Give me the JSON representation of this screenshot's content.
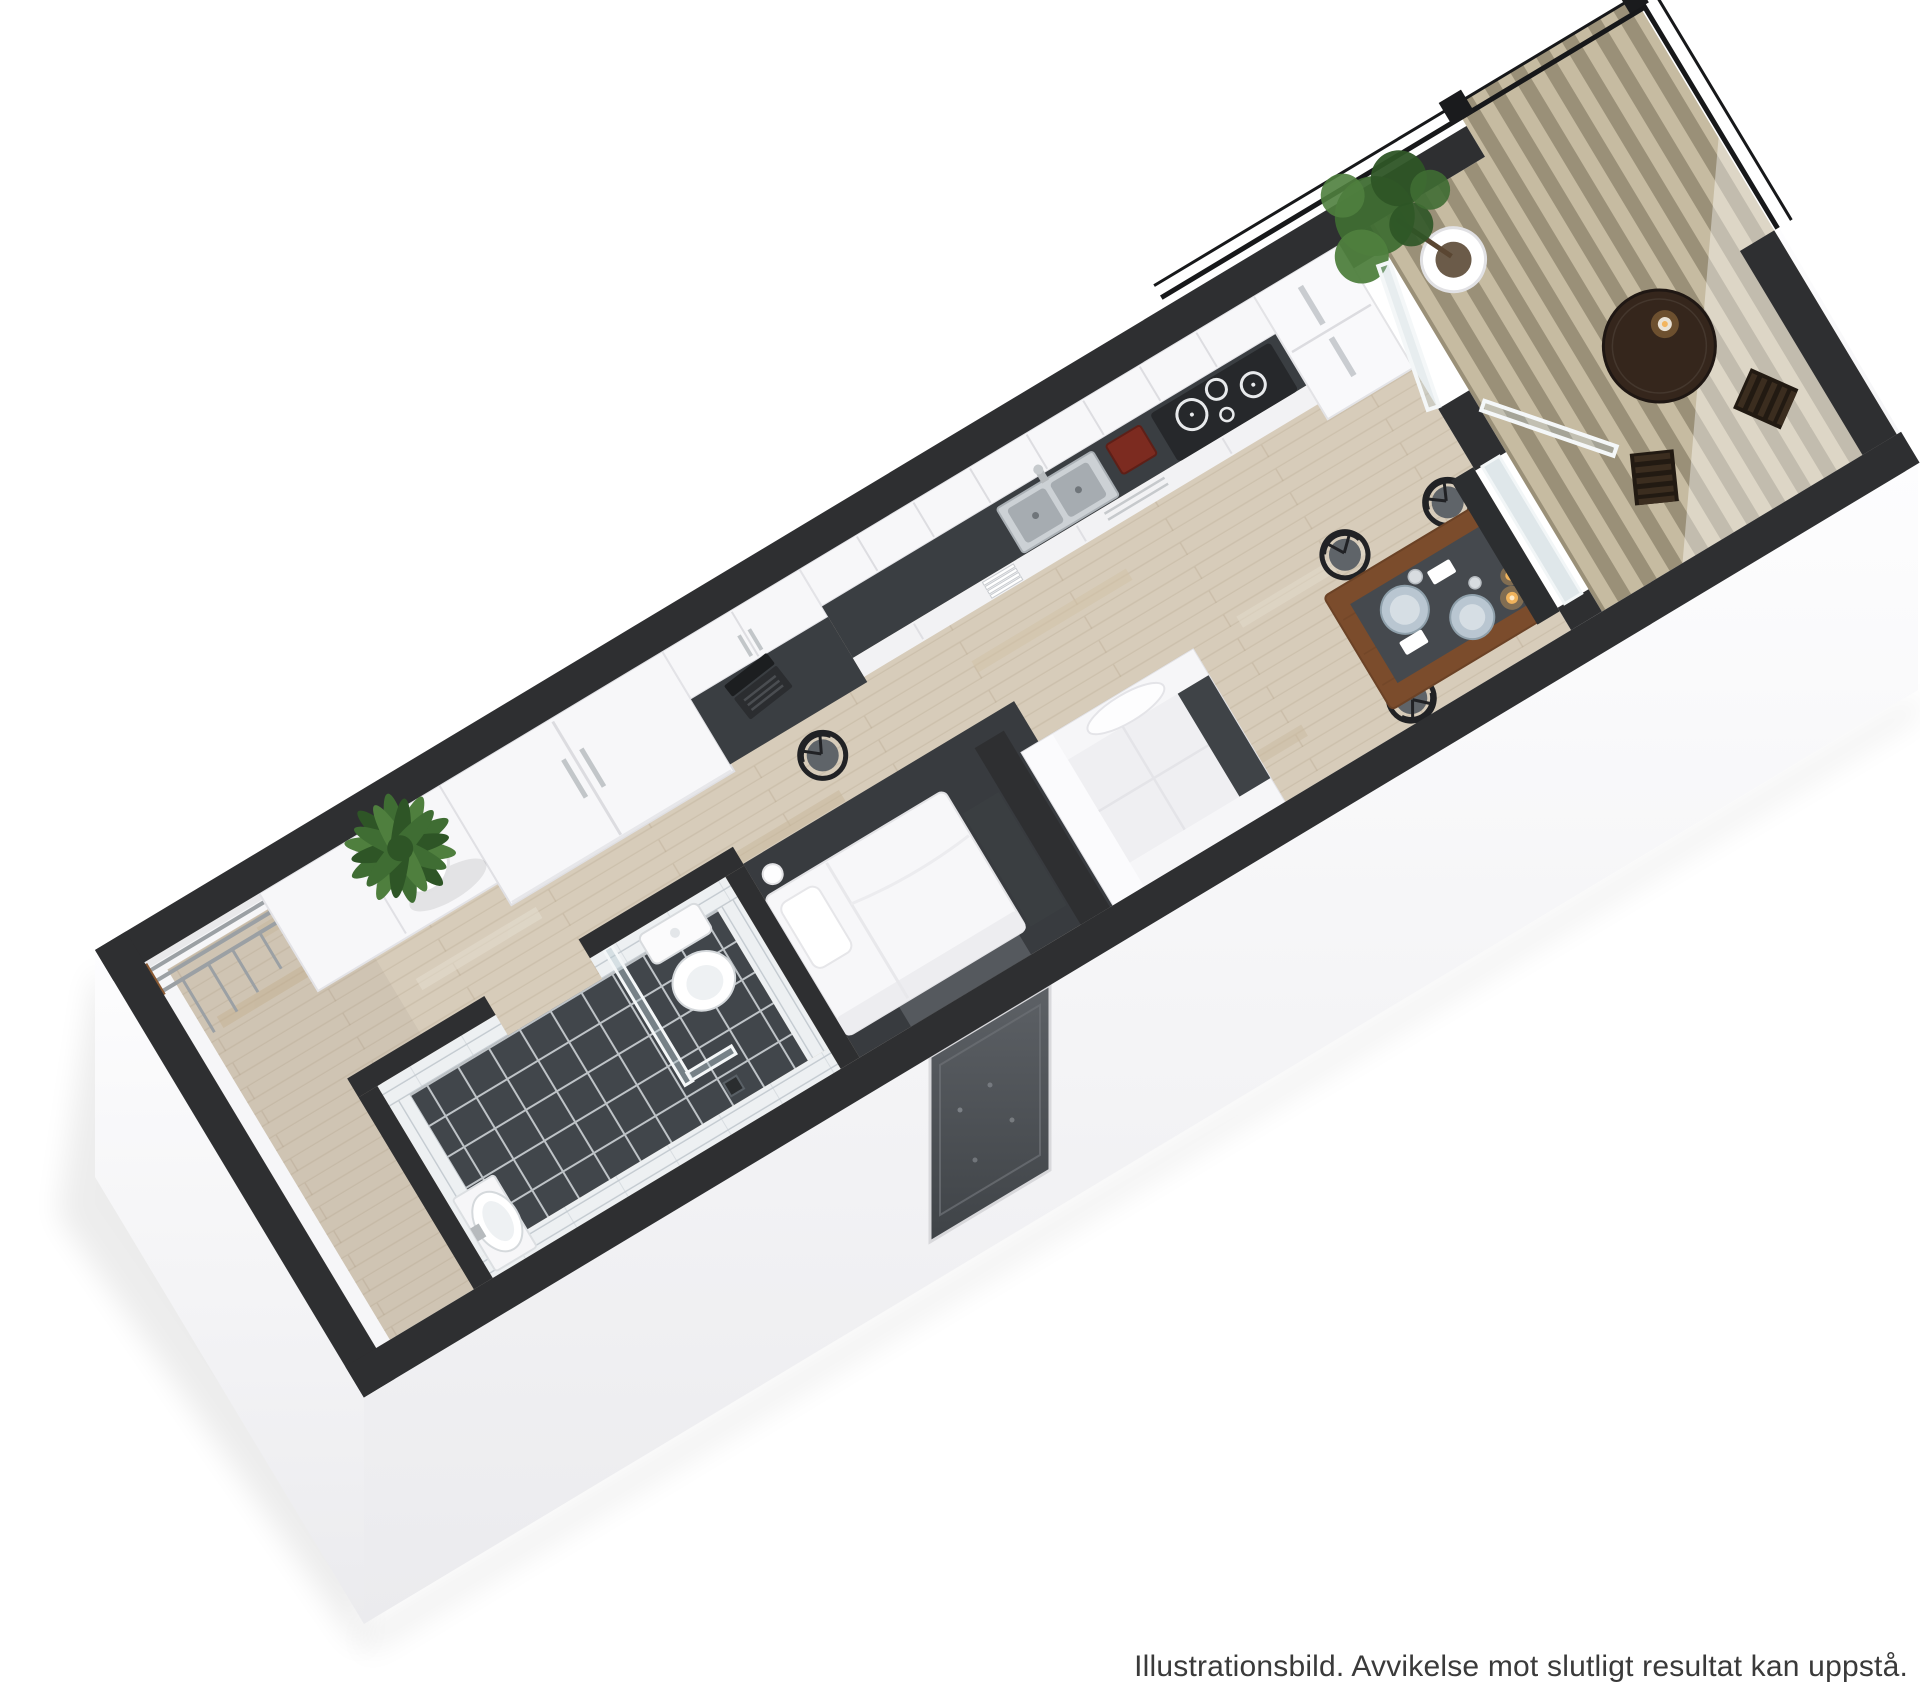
{
  "caption": {
    "text": "Illustrationsbild. Avvikelse mot slutligt resultat kan uppstå."
  },
  "colors": {
    "background": "#ffffff",
    "wall": "#2e2f31",
    "wall_face": "#fcfcfd",
    "wall_face_shade": "#e9e9ed",
    "wood_floor": "#d7ccba",
    "wood_plank_line": "#c2b5a0",
    "nook_floor": "#383b3f",
    "tile_floor": "#41464b",
    "tile_grout": "#ccd1d5",
    "tile_wall": "#edf0f2",
    "tile_wall_seam": "#c3cad0",
    "countertop": "#3a3e42",
    "cabinet_white": "#f7f7f9",
    "cabinet_edge": "#e3e3e7",
    "sink_steel": "#ccd1d5",
    "sink_bowl": "#a6acb1",
    "cooktop": "#26282b",
    "cooktop_ring": "#e8eaec",
    "coffee_machine": "#7c2b20",
    "fridge": "#f9f9fb",
    "sofa": "#f3f3f5",
    "cushion_dark": "#3f4347",
    "bed": "#f7f7f9",
    "chest_dark": "#3a3e41",
    "table_wood": "#7b4c2c",
    "table_runner": "#45494e",
    "plate": "#b9c6d1",
    "candle": "#f0b35c",
    "chair_frame": "#212225",
    "chair_seat": "#5f6469",
    "glass": "#b9cad1",
    "glass_frame": "#f4f7f8",
    "deck_light": "#c6bba1",
    "deck_dark": "#9a9078",
    "balcony_table": "#35261c",
    "plant_green": "#3f6d33",
    "plant_green_dark": "#2e5526",
    "plant_green_light": "#4f7f3e",
    "pot": "#ffffff",
    "trunk": "#5a4632",
    "railing": "#17181a",
    "window_sill": "#2c2e30",
    "entrance_door_top": "#5d6166",
    "entrance_door_bottom": "#3f4347",
    "mat": "#55595e",
    "caption_color": "#3a3a3a"
  },
  "scene": {
    "rooms": [
      "hall",
      "bathroom",
      "sleeping-alcove",
      "kitchen",
      "living-dining",
      "balcony"
    ],
    "furniture": [
      "coat-rack",
      "potted-plant",
      "washbasin",
      "toilet",
      "shower-glass",
      "bed",
      "storage-chest",
      "wardrobe",
      "desk",
      "laptop",
      "desk-chair",
      "kitchen-counter",
      "sink",
      "coffee-machine",
      "cooktop",
      "dishwasher",
      "fridge",
      "sofa",
      "dining-table",
      "dining-chairs",
      "balcony-table",
      "balcony-chairs",
      "balcony-tree",
      "glass-door",
      "railing",
      "entrance-door"
    ]
  }
}
